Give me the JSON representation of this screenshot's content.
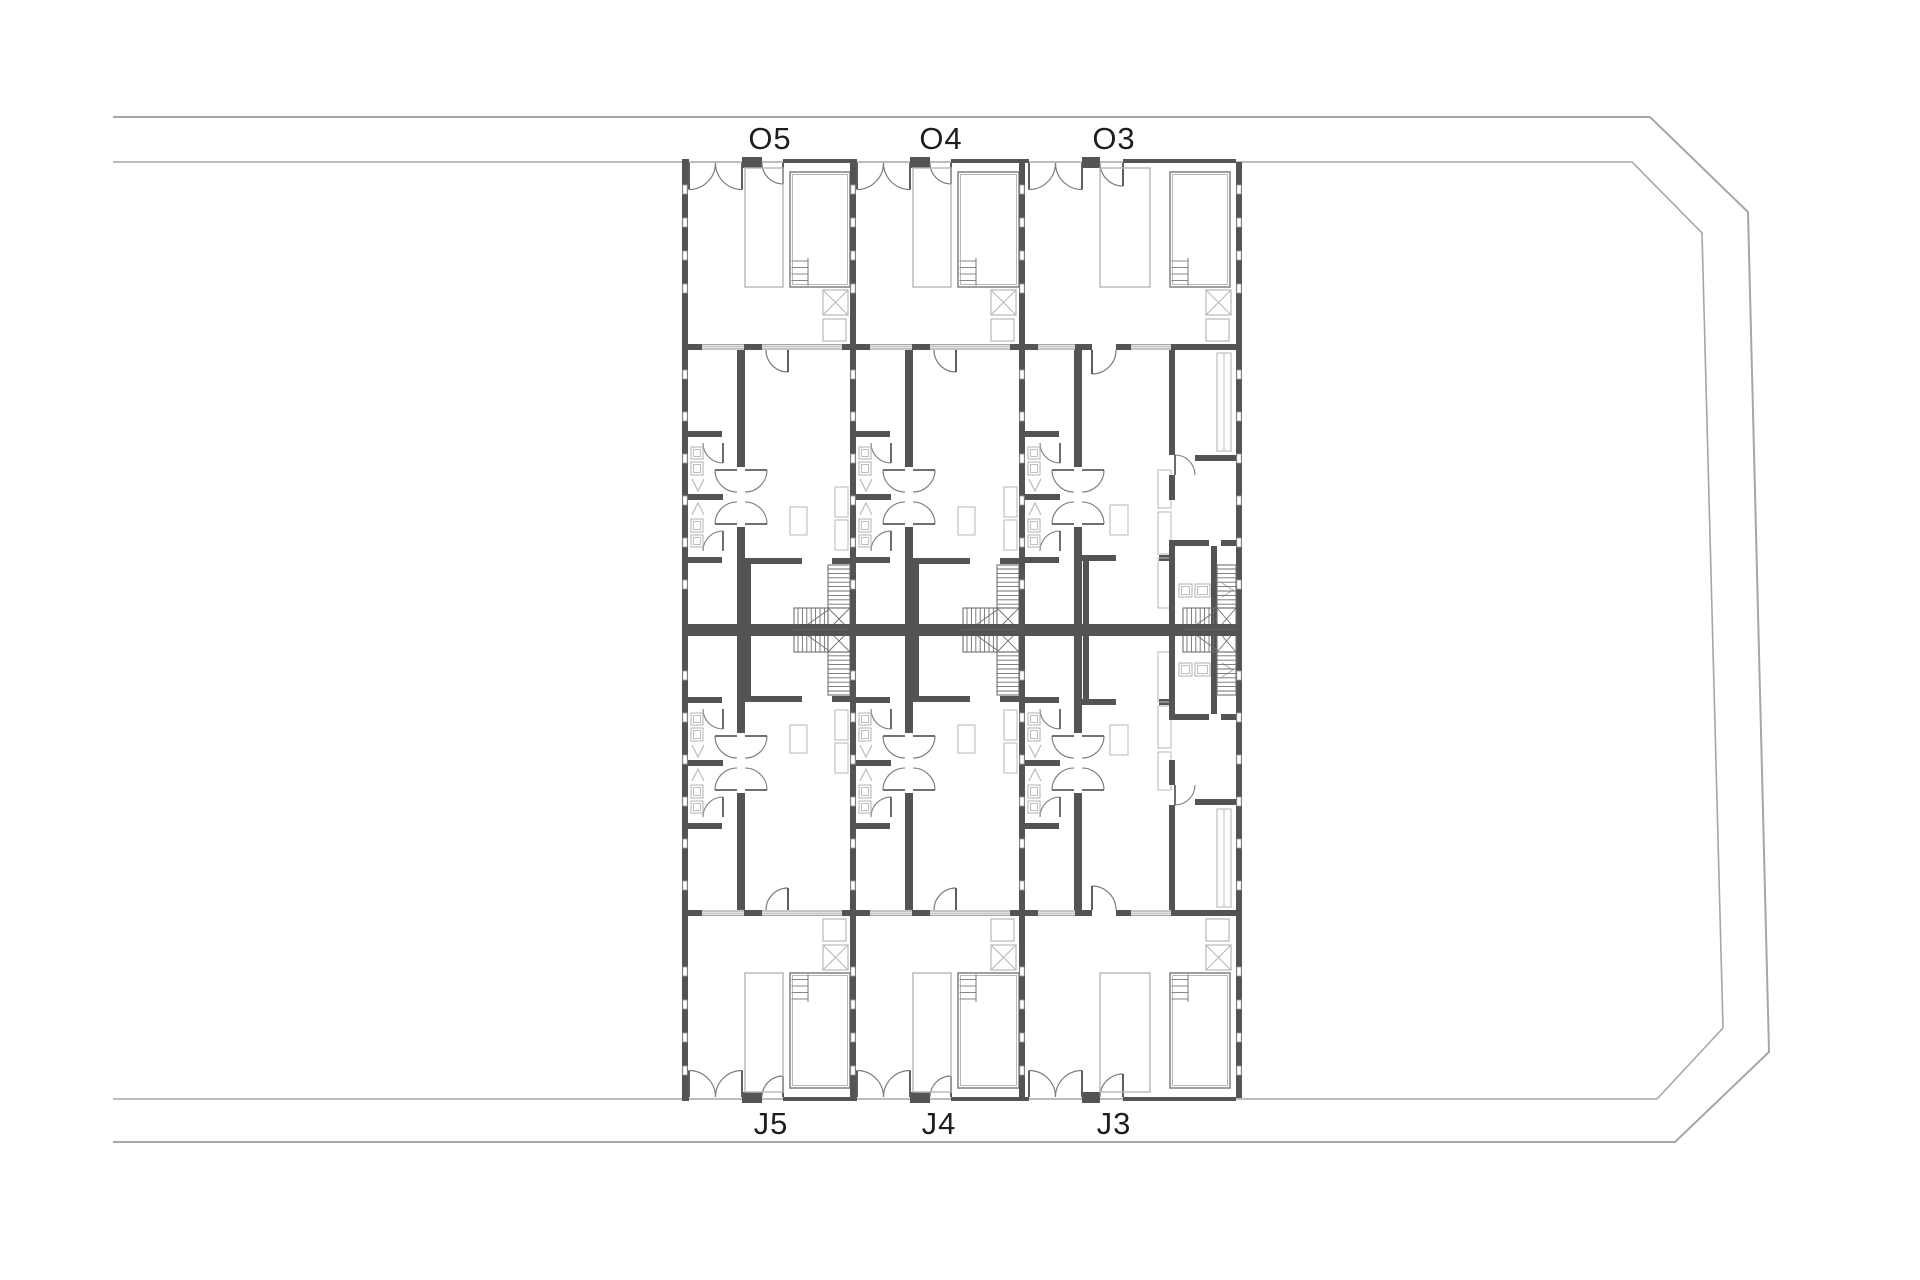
{
  "drawing": {
    "type": "architectural-site-plan",
    "background": "#ffffff"
  },
  "colors": {
    "wall": "#545454",
    "wall_dark": "#3f3f3f",
    "boundary": "#a6a6a6",
    "thin_line": "#8a8a8a",
    "light_line": "#b7b7b7",
    "stair_line": "#6f6f6f",
    "text": "#1e1e1e"
  },
  "labels": {
    "top": [
      {
        "text": "O5",
        "x": 770,
        "y": 149
      },
      {
        "text": "O4",
        "x": 941,
        "y": 149
      },
      {
        "text": "O3",
        "x": 1114,
        "y": 149
      }
    ],
    "bottom": [
      {
        "text": "J5",
        "x": 771,
        "y": 1134
      },
      {
        "text": "J4",
        "x": 939,
        "y": 1134
      },
      {
        "text": "J3",
        "x": 1114,
        "y": 1134
      }
    ]
  },
  "units": [
    {
      "id": "u5",
      "top_label": "O5",
      "bottom_label": "J5",
      "x": 682,
      "width": 168,
      "type": "narrow",
      "last": false
    },
    {
      "id": "u4",
      "top_label": "O4",
      "bottom_label": "J4",
      "x": 850,
      "width": 169,
      "type": "narrow",
      "last": false
    },
    {
      "id": "u3",
      "top_label": "O3",
      "bottom_label": "J3",
      "x": 1019,
      "width": 217,
      "type": "wide",
      "last": true
    }
  ]
}
